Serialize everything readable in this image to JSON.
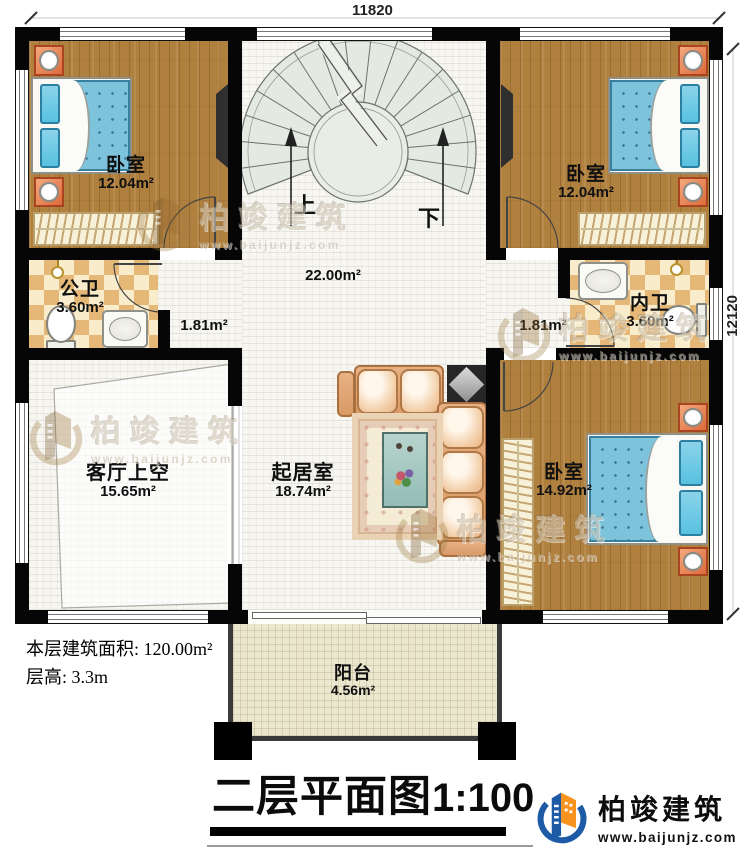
{
  "dimensions": {
    "width_top": "11820",
    "height_right": "12120"
  },
  "stair": {
    "up": "上",
    "down": "下"
  },
  "rooms": {
    "bedroom_tl": {
      "name": "卧室",
      "area": "12.04m²"
    },
    "bedroom_tr": {
      "name": "卧室",
      "area": "12.04m²"
    },
    "public_bath": {
      "name": "公卫",
      "area": "3.60m²"
    },
    "inner_bath": {
      "name": "内卫",
      "area": "3.60m²"
    },
    "corridor_left": {
      "area": "1.81m²"
    },
    "corridor_right": {
      "area": "1.81m²"
    },
    "stair_hall": {
      "area": "22.00m²"
    },
    "living_void": {
      "name": "客厅上空",
      "area": "15.65m²"
    },
    "living": {
      "name": "起居室",
      "area": "18.74m²"
    },
    "bedroom_br": {
      "name": "卧室",
      "area": "14.92m²"
    },
    "balcony": {
      "name": "阳台",
      "area": "4.56m²"
    }
  },
  "notes": {
    "floor_area": "本层建筑面积: 120.00m²",
    "floor_height": "层高: 3.3m"
  },
  "title": {
    "text": "二层平面图",
    "scale": "1:100"
  },
  "brand": {
    "name": "柏竣建筑",
    "url": "www.baijunjz.com"
  },
  "watermark": {
    "name": "柏竣建筑",
    "url": "www.baijunjz.com"
  },
  "colors": {
    "wall": "#060606",
    "wood": "#b0803f",
    "tile": "#f7f6f1",
    "checker_dark": "#e5b877",
    "checker_light": "#f8ecca",
    "balcony": "#ebe7ce",
    "bed_blue": "#7ec3dc",
    "brand_blue": "#1d5ba6",
    "brand_orange": "#f7941d"
  }
}
